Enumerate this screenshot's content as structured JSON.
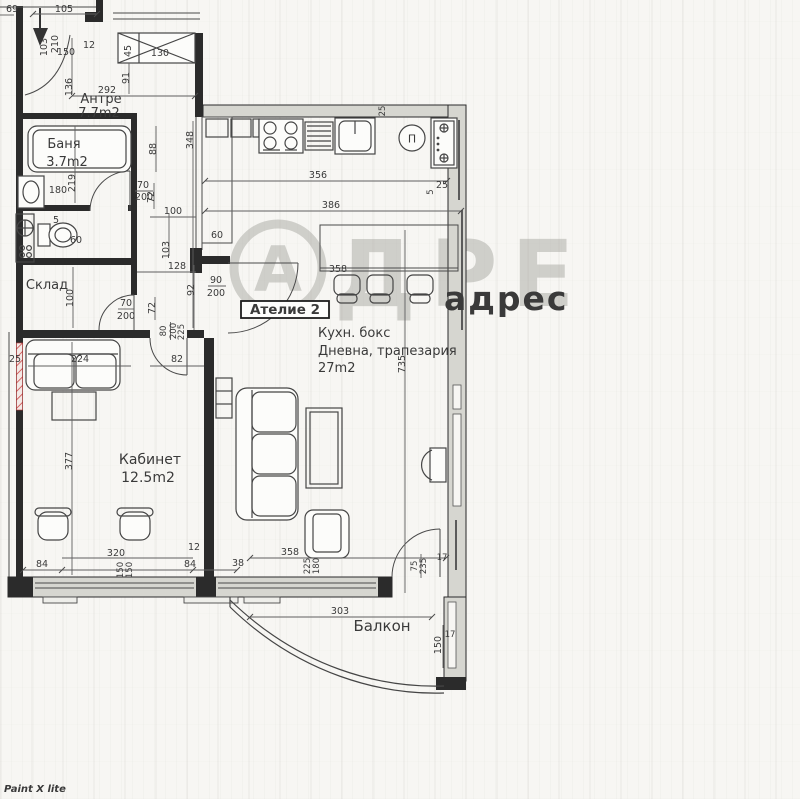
{
  "watermark": {
    "circle_letter": "А",
    "brand_rest": "ДРЕ",
    "brand_small": "адрес",
    "editor": "Paint X lite"
  },
  "badge": {
    "label": "Ателие 2"
  },
  "rooms": {
    "antre": {
      "name": "Антре",
      "area": "7.7m2"
    },
    "bath": {
      "name": "Баня",
      "area": "3.7m2"
    },
    "sklad": {
      "name": "Склад"
    },
    "kabinet": {
      "name": "Кабинет",
      "area": "12.5m2"
    },
    "living": {
      "name_line1": "Кухн. бокс",
      "name_line2": "Дневна, трапезария",
      "area": "27m2"
    },
    "balcony": {
      "name": "Балкон"
    }
  },
  "fixtures": {
    "washer_label": "П"
  },
  "dims": {
    "t69": "69",
    "t105": "105",
    "c103": "103",
    "c210": "210",
    "c150": "150",
    "c12": "12",
    "cl45": "45",
    "cl130": "130",
    "a136": "136",
    "a292": "292",
    "a91": "91",
    "b348": "348",
    "b88": "88",
    "b219": "219",
    "b180": "180",
    "b72": "72",
    "b70": "70",
    "b200": "200",
    "b100": "100",
    "wc5": "5",
    "wc60": "60",
    "wc103": "103",
    "s100": "100",
    "s70": "70",
    "s200": "200",
    "s72": "72",
    "s128": "128",
    "s92": "92",
    "s90": "90",
    "s90d": "200",
    "s80": "80",
    "s80d": "200",
    "s225": "225",
    "k25t": "25",
    "k356": "356",
    "k386": "386",
    "k25r": "25",
    "k5": "5",
    "k60": "60",
    "k358": "358",
    "k735": "735",
    "ka224": "224",
    "ka82": "82",
    "ka377": "377",
    "ka25": "25",
    "bo84a": "84",
    "bo320": "320",
    "bo150a": "150",
    "bo150b": "150",
    "bo12": "12",
    "bo84b": "84",
    "bo38": "38",
    "bo358": "358",
    "ar225": "225",
    "ar180": "180",
    "bd75": "75",
    "bd235": "235",
    "bd17": "17",
    "bl303": "303",
    "bl150": "150",
    "bl17": "17"
  }
}
